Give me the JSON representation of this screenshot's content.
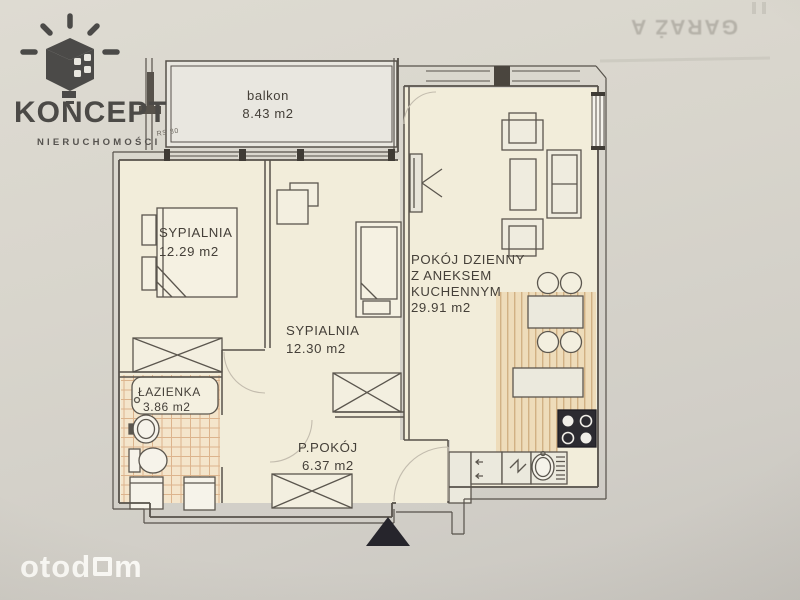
{
  "branding": {
    "logo_title": "KONCEPT",
    "logo_subtitle": "NIERUCHOMOŚCI",
    "watermark_full": "otodom",
    "watermark_part_a": "otod",
    "watermark_part_b": "m"
  },
  "bleed_through_text": "GARAŻ A",
  "plan": {
    "note_rs": "RS 80",
    "rooms": {
      "balcony": {
        "name": "balkon",
        "area": "8.43 m2"
      },
      "bedroom1": {
        "name": "SYPIALNIA",
        "area": "12.29 m2"
      },
      "bedroom2": {
        "name": "SYPIALNIA",
        "area": "12.30 m2"
      },
      "living": {
        "line1": "POKÓJ DZIENNY",
        "line2": "Z ANEKSEM",
        "line3": "KUCHENNYM",
        "area": "29.91 m2"
      },
      "bathroom": {
        "name": "ŁAZIENKA",
        "area": "3.86 m2"
      },
      "hall": {
        "name": "P.POKÓJ",
        "area": "6.37 m2"
      }
    },
    "colors": {
      "wall": "#57524b",
      "room_fill": "#f2edda",
      "balcony_fill": "#e9e7e0",
      "kitchen_floor": "#eedcba",
      "kitchen_stripe": "#c59e6e",
      "tile_floor": "#f4e5cb",
      "tile_line": "#d8ac82",
      "entrance_marker": "#26252c"
    }
  }
}
